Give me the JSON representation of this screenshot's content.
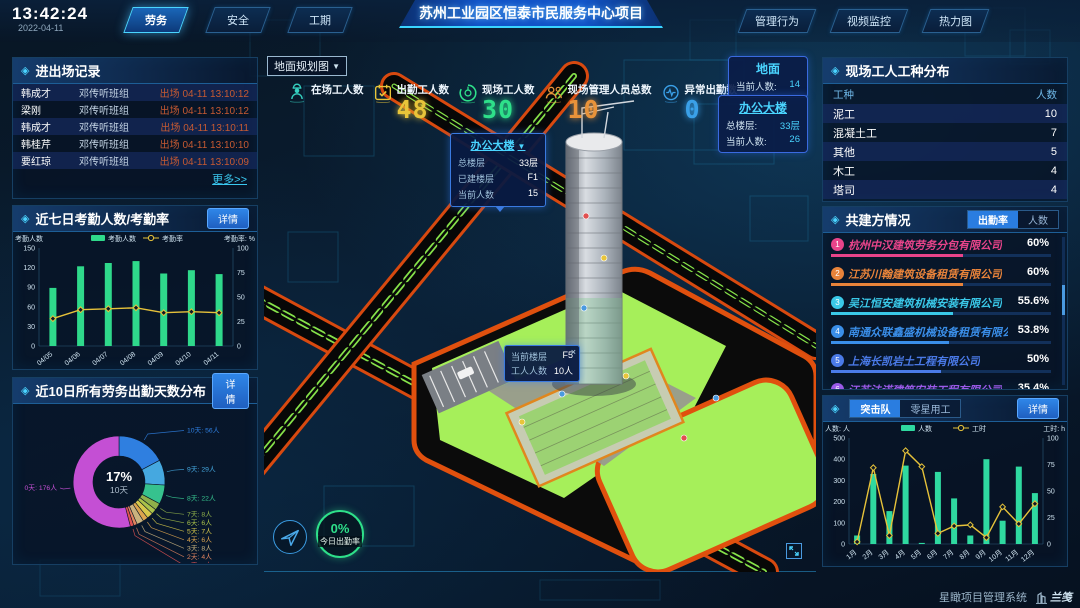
{
  "header": {
    "time": "13:42:24",
    "date": "2022-04-11",
    "left_tabs": [
      {
        "label": "劳务",
        "active": true
      },
      {
        "label": "安全",
        "active": false
      },
      {
        "label": "工期",
        "active": false
      }
    ],
    "title": "苏州工业园区恒泰市民服务中心项目",
    "right_tabs": [
      {
        "label": "管理行为"
      },
      {
        "label": "视频监控"
      },
      {
        "label": "热力图"
      }
    ]
  },
  "left": {
    "records": {
      "title": "进出场记录",
      "rows": [
        {
          "name": "韩成才",
          "team": "邓传听班组",
          "event": "出场 04-11 13:10:12"
        },
        {
          "name": "梁刚",
          "team": "邓传听班组",
          "event": "出场 04-11 13:10:12"
        },
        {
          "name": "韩成才",
          "team": "邓传听班组",
          "event": "出场 04-11 13:10:11"
        },
        {
          "name": "韩桂芹",
          "team": "邓传听班组",
          "event": "出场 04-11 13:10:10"
        },
        {
          "name": "要红琼",
          "team": "邓传听班组",
          "event": "出场 04-11 13:10:09"
        }
      ],
      "more": "更多>>"
    },
    "attendance": {
      "title": "近七日考勤人数/考勤率",
      "detail": "详情"
    },
    "distribution": {
      "title": "近10日所有劳务出勤天数分布",
      "detail": "详情"
    }
  },
  "center": {
    "view_select": {
      "value": "地面规划图"
    },
    "stats": [
      {
        "label": "在场工人数",
        "value": "",
        "icon": "worker-icon",
        "color": "#35d0c0"
      },
      {
        "label": "出勤工人数",
        "value": "48",
        "icon": "calendar-icon",
        "color": "#e8c53a"
      },
      {
        "label": "现场工人数",
        "value": "30",
        "icon": "gauge-icon",
        "color": "#2ee08a"
      },
      {
        "label": "现场管理人员总数",
        "value": "10",
        "icon": "people-icon",
        "color": "#e8933a"
      },
      {
        "label": "异常出勤数",
        "value": "0",
        "icon": "pulse-icon",
        "color": "#3aa0e8"
      }
    ],
    "building_popup": {
      "title": "办公大楼",
      "rows": [
        {
          "label": "总楼层",
          "value": "33层"
        },
        {
          "label": "已建楼层",
          "value": "F1"
        },
        {
          "label": "当前人数",
          "value": "15"
        }
      ]
    },
    "floor_tooltip": {
      "close": "×",
      "rows": [
        {
          "label": "当前楼层",
          "value": "F5"
        },
        {
          "label": "工人人数",
          "value": "10人"
        }
      ]
    },
    "floor_cards": [
      {
        "title": "地面",
        "rows": [
          {
            "label": "当前人数:",
            "value": "14"
          }
        ]
      },
      {
        "title": "办公大楼",
        "rows": [
          {
            "label": "总楼层:",
            "value": "33层"
          },
          {
            "label": "当前人数:",
            "value": "26"
          }
        ]
      }
    ],
    "today_ring": {
      "percent": "0%",
      "label": "今日出勤率"
    }
  },
  "right": {
    "trades": {
      "title": "现场工人工种分布",
      "col_type": "工种",
      "col_count": "人数",
      "rows": [
        {
          "type": "泥工",
          "count": "10"
        },
        {
          "type": "混凝土工",
          "count": "7"
        },
        {
          "type": "其他",
          "count": "5"
        },
        {
          "type": "木工",
          "count": "4"
        },
        {
          "type": "塔司",
          "count": "4"
        }
      ]
    },
    "partners": {
      "title": "共建方情况",
      "tabs": [
        {
          "label": "出勤率",
          "active": true
        },
        {
          "label": "人数",
          "active": false
        }
      ],
      "companies": [
        {
          "rank": "1",
          "name": "杭州中汉建筑劳务分包有限公司",
          "value": "60%",
          "pct": 60,
          "color": "#e8448a"
        },
        {
          "rank": "2",
          "name": "江苏川翰建筑设备租赁有限公司",
          "value": "60%",
          "pct": 60,
          "color": "#e8833a"
        },
        {
          "rank": "3",
          "name": "吴江恒安建筑机械安装有限公司",
          "value": "55.6%",
          "pct": 55.6,
          "color": "#3ac8e8"
        },
        {
          "rank": "4",
          "name": "南通众联鑫盛机械设备租赁有限公司",
          "value": "53.8%",
          "pct": 53.8,
          "color": "#3a8ee8"
        },
        {
          "rank": "5",
          "name": "上海长凯岩土工程有限公司",
          "value": "50%",
          "pct": 50,
          "color": "#4a7ae8"
        },
        {
          "rank": "6",
          "name": "江苏法诺建筑安装工程有限公司",
          "value": "35.4%",
          "pct": 35.4,
          "color": "#9a5ae8"
        }
      ]
    },
    "squad": {
      "tabs": [
        {
          "label": "突击队",
          "active": true
        },
        {
          "label": "零星用工",
          "active": false
        }
      ],
      "detail": "详情"
    }
  },
  "footer": {
    "system": "星瞰项目管理系统",
    "logo": "兰笺"
  },
  "chart_data": [
    {
      "id": "attendance7",
      "type": "bar",
      "title": "近七日考勤人数/考勤率",
      "categories": [
        "04/05",
        "04/06",
        "04/07",
        "04/08",
        "04/09",
        "04/10",
        "04/11"
      ],
      "series": [
        {
          "name": "考勤人数",
          "type": "bar",
          "axis": "left",
          "color": "#2fd98b",
          "values": [
            89,
            122,
            127,
            130,
            111,
            116,
            110
          ]
        },
        {
          "name": "考勤率",
          "type": "line",
          "axis": "right",
          "color": "#e6c23a",
          "values": [
            28,
            37,
            38,
            39,
            34,
            35,
            34
          ]
        }
      ],
      "ylabel_left": "考勤人数",
      "ylabel_right": "考勤率: %",
      "yticks_left": [
        0,
        30,
        60,
        90,
        120,
        150
      ],
      "yticks_right": [
        0,
        25,
        50,
        75,
        100
      ],
      "ylim_left": [
        0,
        150
      ],
      "ylim_right": [
        0,
        100
      ],
      "legend_position": "top",
      "grid": false
    },
    {
      "id": "attendance_days",
      "type": "pie",
      "title": "近10日所有劳务出勤天数分布",
      "center_value": "17%",
      "center_label": "10天",
      "slices": [
        {
          "label": "10天",
          "count": "56人",
          "value": 56,
          "color": "#2f7fe0"
        },
        {
          "label": "9天",
          "count": "29人",
          "value": 29,
          "color": "#45a8e0"
        },
        {
          "label": "8天",
          "count": "22人",
          "value": 22,
          "color": "#36c28e"
        },
        {
          "label": "7天",
          "count": "8人",
          "value": 8,
          "color": "#8fb04a"
        },
        {
          "label": "6天",
          "count": "6人",
          "value": 6,
          "color": "#aac24a"
        },
        {
          "label": "5天",
          "count": "7人",
          "value": 7,
          "color": "#d6c84a"
        },
        {
          "label": "4天",
          "count": "6人",
          "value": 6,
          "color": "#dca44e"
        },
        {
          "label": "3天",
          "count": "8人",
          "value": 8,
          "color": "#c9b27e"
        },
        {
          "label": "2天",
          "count": "4人",
          "value": 4,
          "color": "#e0835e"
        },
        {
          "label": "1天",
          "count": "4人",
          "value": 4,
          "color": "#e05252"
        },
        {
          "label": "0天",
          "count": "176人",
          "value": 176,
          "color": "#c44fd4"
        }
      ]
    },
    {
      "id": "squad_monthly",
      "type": "bar",
      "title": "突击队",
      "categories": [
        "1月",
        "2月",
        "3月",
        "4月",
        "5月",
        "6月",
        "7月",
        "8月",
        "9月",
        "10月",
        "11月",
        "12月"
      ],
      "series": [
        {
          "name": "人数",
          "type": "bar",
          "axis": "left",
          "color": "#2fd9a0",
          "values": [
            40,
            330,
            155,
            370,
            5,
            340,
            215,
            40,
            400,
            110,
            365,
            240
          ]
        },
        {
          "name": "工时",
          "type": "line",
          "axis": "right",
          "color": "#e6c23a",
          "values": [
            2,
            72,
            8,
            88,
            73,
            10,
            17,
            18,
            6,
            35,
            19,
            38
          ]
        }
      ],
      "ylabel_left": "人数: 人",
      "ylabel_right": "工时: h",
      "yticks_left": [
        0,
        100,
        200,
        300,
        400,
        500
      ],
      "yticks_right": [
        0,
        25,
        50,
        75,
        100
      ],
      "ylim_left": [
        0,
        500
      ],
      "ylim_right": [
        0,
        100
      ],
      "legend_position": "top",
      "grid": false
    }
  ]
}
